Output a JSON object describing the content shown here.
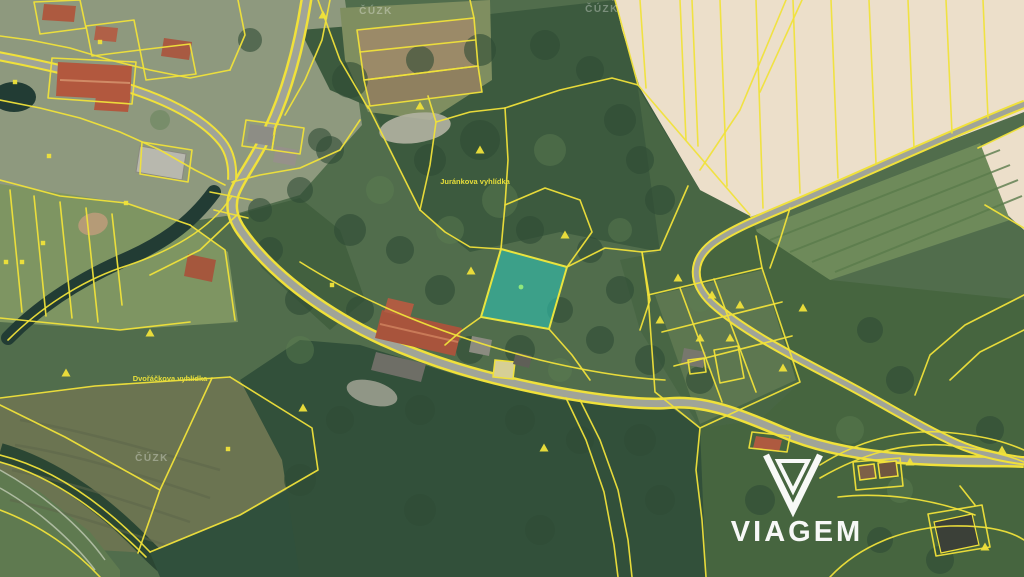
{
  "labels": {
    "viewpoint1": "Juránkova vyhlídka",
    "viewpoint2": "Dvořáčkova vyhlídka"
  },
  "watermark": {
    "text": "ČÚZK"
  },
  "logo": {
    "text": "VIAGEM",
    "icon": "gem-v-icon"
  },
  "highlighted_parcel": {
    "description": "teal highlighted square parcel in map center"
  },
  "colors": {
    "cadastral_line": "#f0e13a",
    "highlight_fill": "#2fc0ae",
    "highlight_border": "#e9e43e",
    "label": "#e8df3a",
    "watermark": "#ffffff",
    "logo": "#ffffff",
    "road": "#a0a498"
  }
}
